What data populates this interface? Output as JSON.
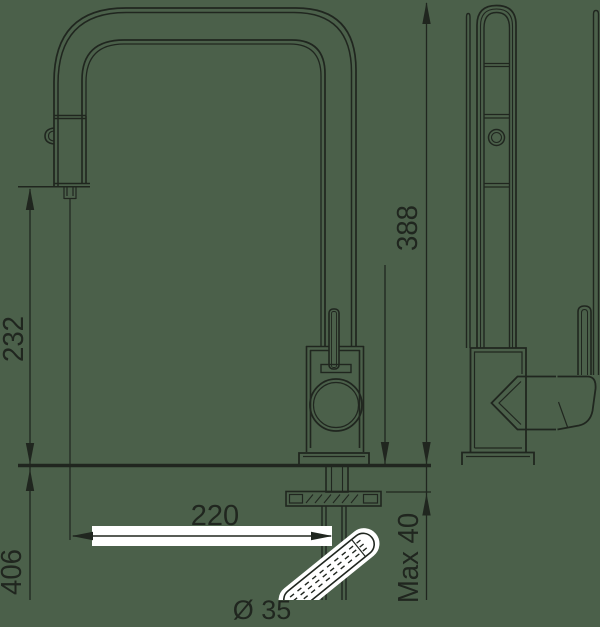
{
  "page": {
    "type": "technical-dimension-drawing",
    "subject": "pull-out-kitchen-faucet-front-and-side-view"
  },
  "colors": {
    "background": "#4b604a",
    "line": "#20261f",
    "white": "#ffffff"
  },
  "dimensions": {
    "spout_outlet_height": "232",
    "overall_height": "388",
    "spout_reach": "220",
    "under_counter_length": "406",
    "max_counter_thickness": "Max 40",
    "bottom_clipped_note": "Ø 35"
  }
}
